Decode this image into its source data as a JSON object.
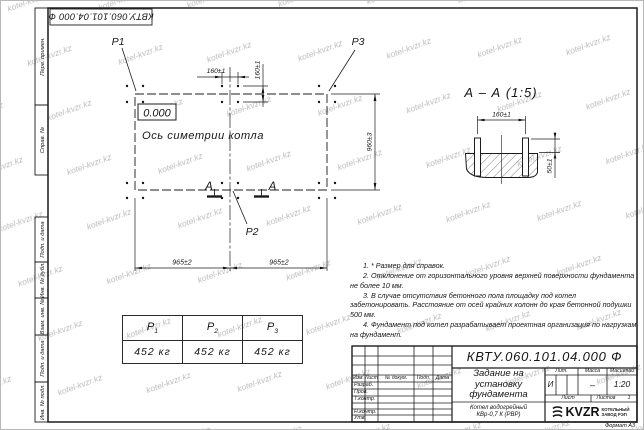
{
  "stamp_top": "КВТУ.060.101.04.000 Ф",
  "watermark": "kotel-kvzr.kz",
  "frame_labels": {
    "perv_primen": "Перв. примен.",
    "sprav_no": "Справ. №",
    "podp_data_1": "Подп. и дата",
    "inv_dubl": "Инв. № дубл.",
    "vzam_inv": "Взам. инв. №",
    "podp_data_2": "Подп. и дата",
    "inv_podl": "Инв. № подл."
  },
  "plan": {
    "labels": {
      "p1": "P1",
      "p2": "P2",
      "p3": "P3",
      "elevation": "0.000",
      "axis": "Ось симетрии котла",
      "section_letter": "А"
    },
    "dims": {
      "bolt_x": "160±1",
      "bolt_y": "160±1",
      "width_left": "965±2",
      "width_right": "965±2",
      "height": "960±3"
    }
  },
  "section": {
    "title": "А – А (1:5)",
    "dims": {
      "bolt_spacing": "160±1",
      "protrusion": "50±1"
    }
  },
  "loads_table": {
    "headers": [
      {
        "base": "P",
        "sub": "1"
      },
      {
        "base": "P",
        "sub": "2"
      },
      {
        "base": "P",
        "sub": "3"
      }
    ],
    "values": [
      "452 кг",
      "452 кг",
      "452 кг"
    ]
  },
  "notes": [
    "1. * Размер для справок.",
    "2. Отклонение от горизонтального уровня верхней поверхности фундамента не более 10 мм.",
    "3. В случае отсутствия бетонного пола площадку под котел забетонировать. Расстояние от осей крайних колонн до края бетонной подушки 500 мм.",
    "4. Фундамент под котел разрабатывает проектная организация по нагрузкам на фундамент."
  ],
  "title_block": {
    "doc_number": "КВТУ.060.101.04.000 Ф",
    "title": "Задание на установку фундамента",
    "subtitle": "Котел водогрейный КВр-0,7 К (РВР)",
    "header_cols": [
      "Изм.",
      "Лист",
      "№ докум.",
      "Подп.",
      "Дата"
    ],
    "rows": [
      "Разраб.",
      "Пров.",
      "Т.контр.",
      "Н.контр.",
      "Утв."
    ],
    "lit_label": "Лит.",
    "lit_value": "И",
    "massa_label": "Масса",
    "massa_value": "–",
    "masshtab_label": "Масштаб",
    "masshtab_value": "1:20",
    "list_label": "Лист",
    "listov_label": "Листов",
    "listov_value": "1",
    "company_logo": "KVZR",
    "company_name": "КОТЕЛЬНЫЙ ЗАВОД РЭП",
    "format": "Формат А3"
  }
}
